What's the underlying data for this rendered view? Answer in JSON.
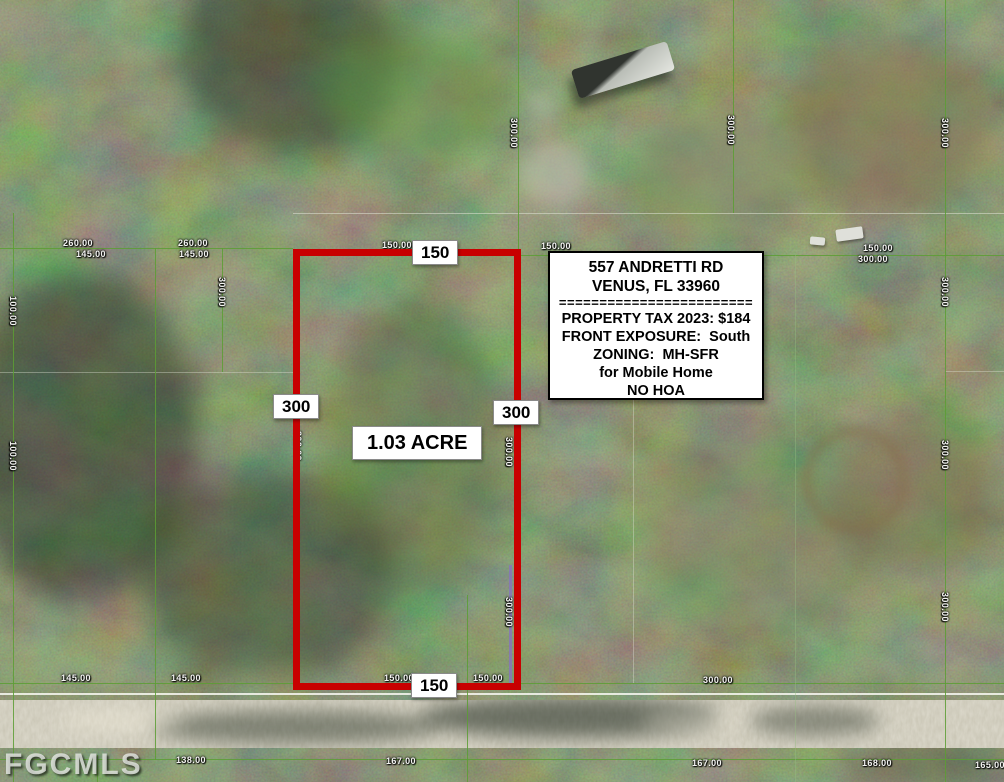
{
  "watermark": "FGCMLS",
  "parcel": {
    "area_label": "1.03 ACRE",
    "width_top": "150",
    "width_bottom": "150",
    "depth_left": "300",
    "depth_right": "300"
  },
  "info_box": {
    "address_line1": "557 ANDRETTI RD",
    "address_line2": "VENUS, FL 33960",
    "divider": "========================",
    "tax_line": "PROPERTY TAX 2023: $184",
    "exposure_line": "FRONT EXPOSURE:  South",
    "zoning_line": "ZONING:  MH-SFR",
    "zoning_line2": "for Mobile Home",
    "hoa_line": "NO HOA"
  },
  "colors": {
    "parcel_red": "#c80000",
    "grid_green": "rgba(92,158,52,0.85)",
    "road_tan": "#c6c2b1"
  },
  "survey_labels": [
    {
      "text": "260.00",
      "x": 78,
      "y": 243,
      "rot": 0
    },
    {
      "text": "145.00",
      "x": 91,
      "y": 254,
      "rot": 0
    },
    {
      "text": "260.00",
      "x": 193,
      "y": 243,
      "rot": 0
    },
    {
      "text": "145.00",
      "x": 194,
      "y": 254,
      "rot": 0
    },
    {
      "text": "150.00",
      "x": 397,
      "y": 245,
      "rot": 0
    },
    {
      "text": "150.00",
      "x": 556,
      "y": 246,
      "rot": 0
    },
    {
      "text": "150.00",
      "x": 878,
      "y": 248,
      "rot": 0
    },
    {
      "text": "300.00",
      "x": 873,
      "y": 259,
      "rot": 0
    },
    {
      "text": "300.00",
      "x": 514,
      "y": 133,
      "rot": 90
    },
    {
      "text": "300.00",
      "x": 731,
      "y": 130,
      "rot": 90
    },
    {
      "text": "300.00",
      "x": 945,
      "y": 133,
      "rot": 90
    },
    {
      "text": "300.00",
      "x": 945,
      "y": 292,
      "rot": 90
    },
    {
      "text": "300.00",
      "x": 945,
      "y": 455,
      "rot": 90
    },
    {
      "text": "300.00",
      "x": 945,
      "y": 607,
      "rot": 90
    },
    {
      "text": "300.00",
      "x": 222,
      "y": 292,
      "rot": 90
    },
    {
      "text": "100.00",
      "x": 13,
      "y": 311,
      "rot": 90
    },
    {
      "text": "100.00",
      "x": 13,
      "y": 456,
      "rot": 90
    },
    {
      "text": "300.00",
      "x": 298,
      "y": 446,
      "rot": 90
    },
    {
      "text": "300.00",
      "x": 509,
      "y": 452,
      "rot": 90
    },
    {
      "text": "300.00",
      "x": 509,
      "y": 612,
      "rot": 90
    },
    {
      "text": "145.00",
      "x": 76,
      "y": 678,
      "rot": 0
    },
    {
      "text": "145.00",
      "x": 186,
      "y": 678,
      "rot": 0
    },
    {
      "text": "150.00",
      "x": 399,
      "y": 678,
      "rot": 0
    },
    {
      "text": "150.00",
      "x": 488,
      "y": 678,
      "rot": 0
    },
    {
      "text": "300.00",
      "x": 718,
      "y": 680,
      "rot": 0
    },
    {
      "text": "138.00",
      "x": 191,
      "y": 760,
      "rot": 0
    },
    {
      "text": "167.00",
      "x": 401,
      "y": 761,
      "rot": 0
    },
    {
      "text": "167.00",
      "x": 707,
      "y": 763,
      "rot": 0
    },
    {
      "text": "168.00",
      "x": 877,
      "y": 763,
      "rot": 0
    },
    {
      "text": "165.00",
      "x": 990,
      "y": 765,
      "rot": 0
    }
  ]
}
